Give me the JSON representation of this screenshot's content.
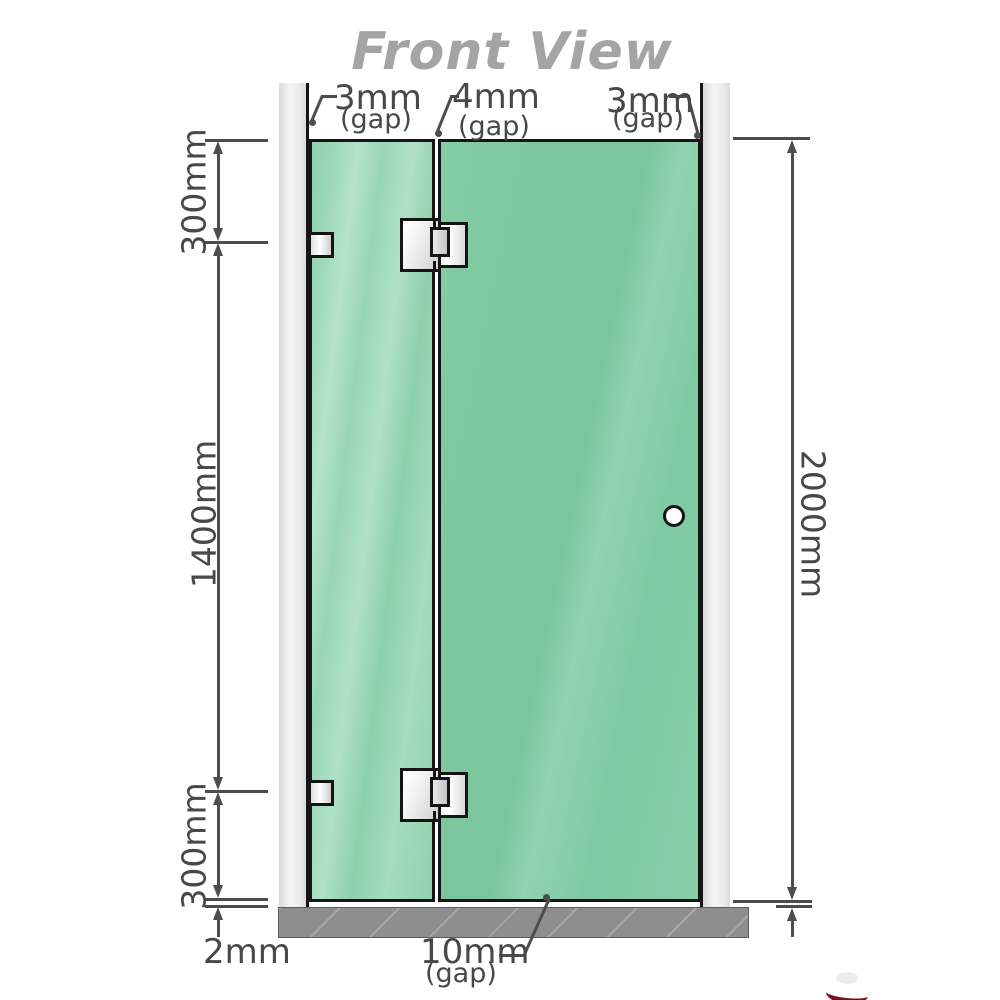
{
  "title": "Front View",
  "colors": {
    "glass": "#7fc9a1",
    "glass_highlight": "#b5e3cb",
    "wall_channel": "#e9e9e9",
    "floor": "#8e8e8e",
    "outline": "#151515",
    "dimension_lines": "#4d4d4d",
    "title_text": "#a4a4a4",
    "hardware_metal": "#f2f2f2",
    "logo_red": "#7a1120"
  },
  "dimensions": {
    "top_gap_left": {
      "value": "3mm",
      "note": "(gap)"
    },
    "top_gap_middle": {
      "value": "4mm",
      "note": "(gap)"
    },
    "top_gap_right": {
      "value": "3mm",
      "note": "(gap)"
    },
    "left_top": "300mm",
    "left_middle": "1400mm",
    "left_bottom": "300mm",
    "right_total": "2000mm",
    "floor_gap": "2mm",
    "bottom_gap": {
      "value": "10mm",
      "note": "(gap)"
    }
  },
  "parts": {
    "left_channel": "wall-channel",
    "right_channel": "wall-channel",
    "fixed_panel": "fixed-glass-panel",
    "door_panel": "hinged-door-panel",
    "hinges": "glass-to-glass-hinge",
    "brackets": "wall-bracket",
    "knob": "door-knob",
    "floor": "floor-strip"
  }
}
